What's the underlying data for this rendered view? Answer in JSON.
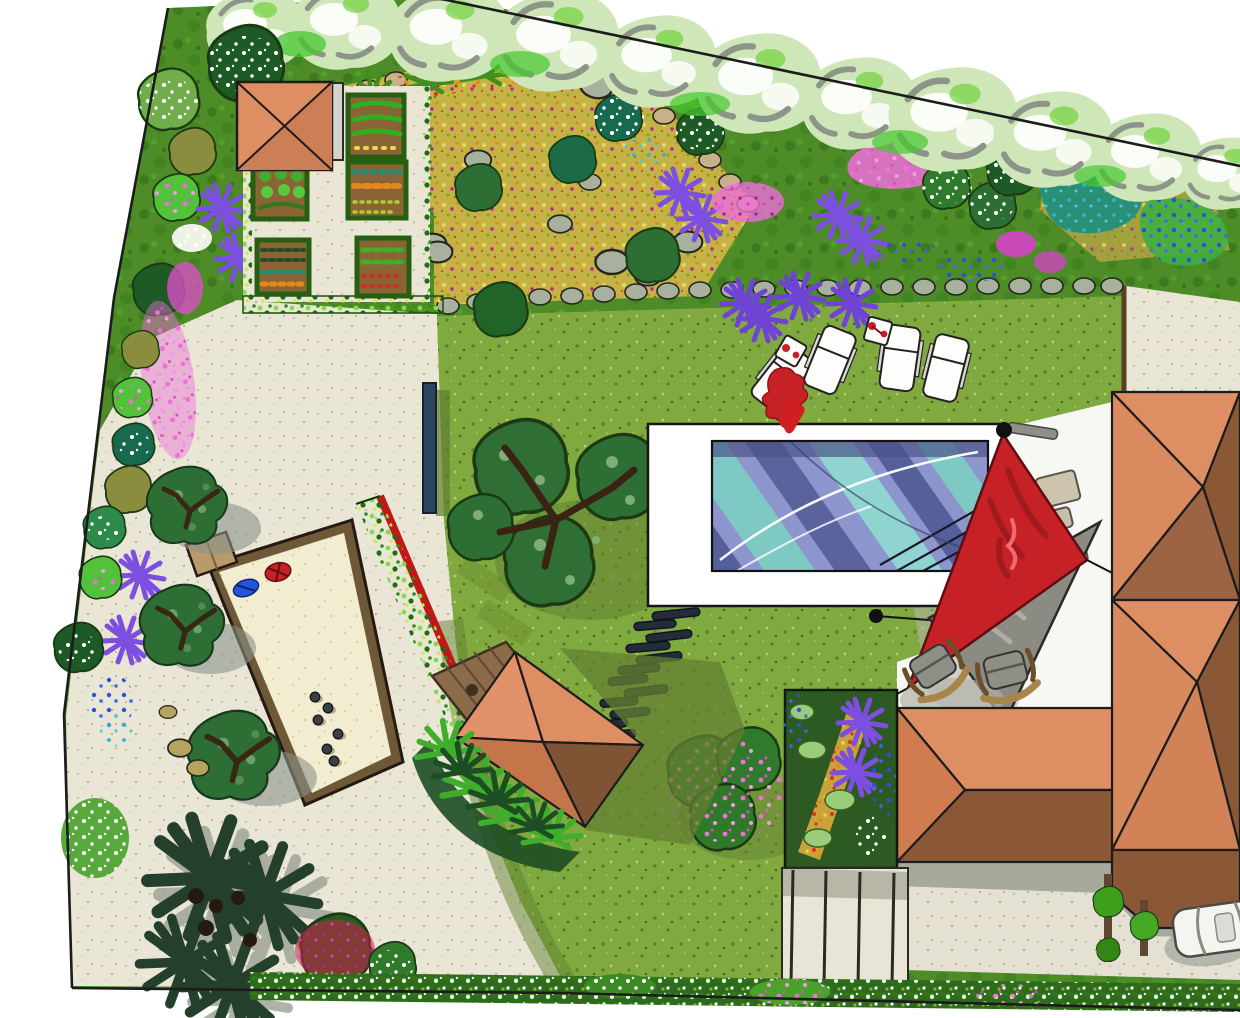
{
  "palette": {
    "outside": "#ffffff",
    "ink": "#1c1c1c",
    "bed_green": "#4d8c27",
    "bed_green_dark": "#2f6b17",
    "canopy_light": "#cfe6b8",
    "lawn": "#80aa40",
    "lawn_shade": "#647f31",
    "gravel_gold": "#c4b344",
    "path": "#e9e6d6",
    "path_shadow": "#b9b6a6",
    "sand": "#f2ecd0",
    "wood": "#6e5838",
    "wood_deck": "#8a6b4a",
    "hedge": "#3f9e1c",
    "hedge_dark": "#2e6b1c",
    "hedge_red": "#c01818",
    "pool_deck": "#ffffff",
    "water": "#8d95cd",
    "water_teal": "#7fc9c5",
    "water_dark": "#555f99",
    "roof_light": "#dd8e62",
    "roof_mid": "#d07c50",
    "roof_dark": "#8a5737",
    "sail_red": "#c52127",
    "sail_gray": "#8b8b83",
    "screen_navy": "#2c4660",
    "terrace": "#f7f7f4",
    "driveway": "#e4e1d2",
    "concrete_gray": "#a7aa9b",
    "steps": "#e8e5d6",
    "shrub_dark": "#2d6e35",
    "shrub_olive": "#8a8c3e",
    "flower_pink": "#ee6fd8",
    "flower_magenta": "#b1258c",
    "flower_purple": "#7d4fe0",
    "flower_blue": "#2255dd",
    "flower_cyan": "#29b6d8",
    "flower_white": "#ffffff",
    "flower_red": "#e03020",
    "flower_orange": "#e8861e",
    "flower_yellow": "#e7d84a",
    "crimson": "#d01f4e",
    "spiky_dark": "#24402c",
    "car": "#f4f4f1",
    "stone_gray": "#a8b09e",
    "stone_tan": "#c6b289"
  },
  "scene": {
    "type": "hand-drawn landscape garden plan, top view",
    "features": [
      "site-boundary",
      "mixed-border-left",
      "mixed-border-top",
      "gravel-rockery-garden",
      "garden-shed",
      "vegetable-garden",
      "lawn",
      "large-tree",
      "pink-flowering-tree",
      "swimming-pool",
      "pool-deck",
      "sun-loungers",
      "side-tables",
      "stepping-stones",
      "shade-sail-red",
      "shade-sail-gray",
      "deck-chairs",
      "terrace",
      "house-hip-roofs",
      "perennial-flower-bed",
      "garden-steps",
      "driveway",
      "parked-car",
      "climber-posts",
      "bottom-hedge",
      "petanque-court",
      "petanque-balls",
      "red-hedge",
      "wooden-deck",
      "pavilion-hip-roof",
      "palm-bed",
      "spiky-grasses",
      "gravel-path",
      "privacy-screen",
      "stone-edging",
      "courtyard-path"
    ],
    "counts": {
      "sun_loungers": 4,
      "side_tables": 2,
      "petanque_balls": 6,
      "stepping_stones": 12,
      "vegetable_beds": 5,
      "shade_sails": 2,
      "deck_chairs": 2,
      "cars": 1,
      "house_roof_sections": 3,
      "garden_steps_treads": 4
    }
  }
}
